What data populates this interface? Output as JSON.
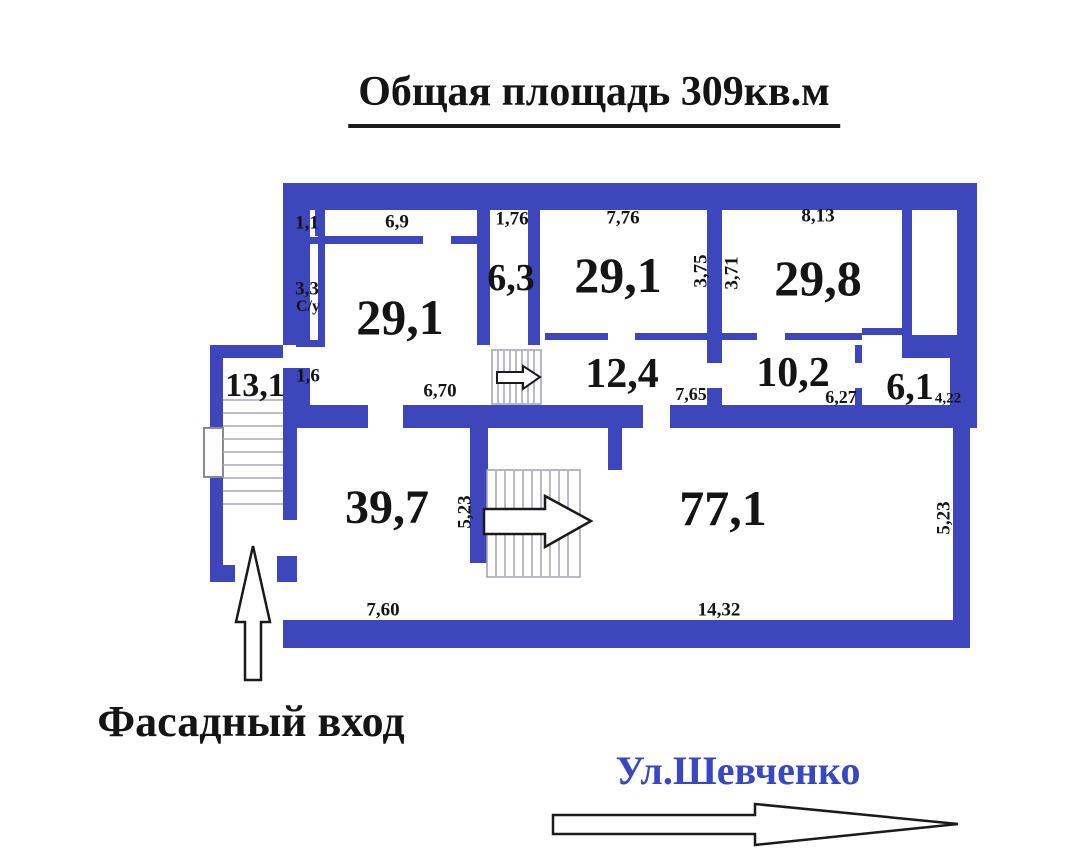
{
  "title": "Общая площадь  309кв.м",
  "colors": {
    "wall": "#3e46bc",
    "street_text": "#3948c0",
    "label_text": "#141414",
    "stair_line": "#a9a9b6"
  },
  "rooms": [
    {
      "name": "room-top-left",
      "area": "29,1"
    },
    {
      "name": "corridor-6-3",
      "area": "6,3"
    },
    {
      "name": "room-top-mid",
      "area": "29,1"
    },
    {
      "name": "room-top-right",
      "area": "29,8"
    },
    {
      "name": "stairwell",
      "area": "13,1"
    },
    {
      "name": "hall-12-4",
      "area": "12,4"
    },
    {
      "name": "hall-10-2",
      "area": "10,2"
    },
    {
      "name": "room-6-1",
      "area": "6,1"
    },
    {
      "name": "room-39-7",
      "area": "39,7"
    },
    {
      "name": "room-77-1",
      "area": "77,1"
    }
  ],
  "dims": [
    {
      "name": "dim-1-1",
      "v": "1,1"
    },
    {
      "name": "dim-6-9",
      "v": "6,9"
    },
    {
      "name": "dim-1-76",
      "v": "1,76"
    },
    {
      "name": "dim-7-76",
      "v": "7,76"
    },
    {
      "name": "dim-8-13",
      "v": "8,13"
    },
    {
      "name": "dim-3-3",
      "v": "3,3"
    },
    {
      "name": "dim-su",
      "v": "С/у"
    },
    {
      "name": "dim-3-75",
      "v": "3,75"
    },
    {
      "name": "dim-3-71",
      "v": "3,71"
    },
    {
      "name": "dim-1-6",
      "v": "1,6"
    },
    {
      "name": "dim-6-70",
      "v": "6,70"
    },
    {
      "name": "dim-7-65",
      "v": "7,65"
    },
    {
      "name": "dim-6-27",
      "v": "6,27"
    },
    {
      "name": "dim-4-22",
      "v": "4,22"
    },
    {
      "name": "dim-5-23-mid",
      "v": "5,23"
    },
    {
      "name": "dim-7-60",
      "v": "7,60"
    },
    {
      "name": "dim-14-32",
      "v": "14,32"
    },
    {
      "name": "dim-5-23-right",
      "v": "5,23"
    }
  ],
  "annotations": {
    "entrance": "Фасадный вход",
    "street": "Ул.Шевченко"
  },
  "icons": [
    {
      "name": "entrance-up-arrow-icon"
    },
    {
      "name": "corridor-stairs-arrow-icon"
    },
    {
      "name": "main-stairs-arrow-icon"
    },
    {
      "name": "street-direction-arrow-icon"
    },
    {
      "name": "stairwell-stairs-icon"
    },
    {
      "name": "corridor-stairs-icon"
    },
    {
      "name": "main-stairs-icon"
    },
    {
      "name": "window-icon"
    }
  ]
}
